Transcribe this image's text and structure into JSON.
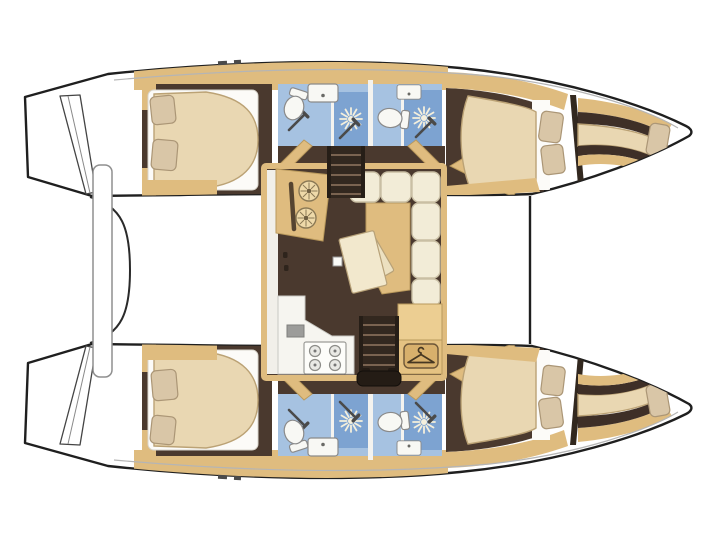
{
  "diagram": {
    "type": "catamaran-interior-deck-plan",
    "orientation": "bow-right",
    "hulls": [
      {
        "name": "upper-hull",
        "rooms": [
          "aft-double-cabin",
          "bathroom-with-separate-shower",
          "bathroom-with-separate-shower",
          "forward-double-cabin",
          "forepeak-berth"
        ]
      },
      {
        "name": "lower-hull",
        "rooms": [
          "aft-double-cabin",
          "bathroom-with-separate-shower",
          "bathroom-with-separate-shower",
          "forward-double-cabin",
          "forepeak-berth"
        ]
      }
    ],
    "saloon": {
      "features": [
        "galley-counter-twin-basins",
        "lower-galley-counter",
        "refrigerator",
        "four-burner-stove",
        "l-shaped-sofa",
        "folding-table",
        "wardrobe-with-hanger",
        "stairs-to-upper-hull",
        "stairs-to-lower-hull"
      ]
    },
    "stern": {
      "features": [
        "transom-steps-upper",
        "transom-steps-lower",
        "aft-platform-bar",
        "cockpit-edge"
      ]
    },
    "bow": {
      "features": [
        "forward-crossbeam"
      ]
    }
  },
  "icons": [
    "shower-rose-starburst-icon",
    "shower-wand-icon",
    "toilet-icon",
    "washbasin-icon",
    "galley-basin-icon",
    "stove-burner-icon",
    "clothes-hanger-icon",
    "pillow-icon",
    "stairs-icon"
  ],
  "colors": {
    "page_bg": "#ffffff",
    "outline": "#1f1f1f",
    "hull_fill": "#ffffff",
    "gunwale": "#b5b5b5",
    "wood_trim": "#dfbc7f",
    "wood_trim_dark": "#b9995c",
    "wood_light": "#ecd6a4",
    "floor_brown": "#4a392e",
    "floor_dark": "#33281f",
    "stair_dark": "#261e17",
    "stair_light": "#7a6350",
    "bed_cream": "#e9d7b2",
    "bed_stroke": "#bba275",
    "pillow": "#d9c6a7",
    "pillow_stroke": "#ab9676",
    "bath_blue": "#a6c2e1",
    "shower_blue": "#7da3d1",
    "fixture_white": "#f8f8f4",
    "fixture_stroke": "#8a8a8a",
    "sofa_cream": "#f2ecd7",
    "sofa_stroke": "#c9bfa4",
    "counter_white": "#f6f5f0",
    "steel": "#9c9c9a",
    "burst": "#f4efdc",
    "wand": "#4a4a4a",
    "hanger_plate": "#d8b06c",
    "hanger_stroke": "#463722",
    "bulkhead": "#32281f"
  }
}
